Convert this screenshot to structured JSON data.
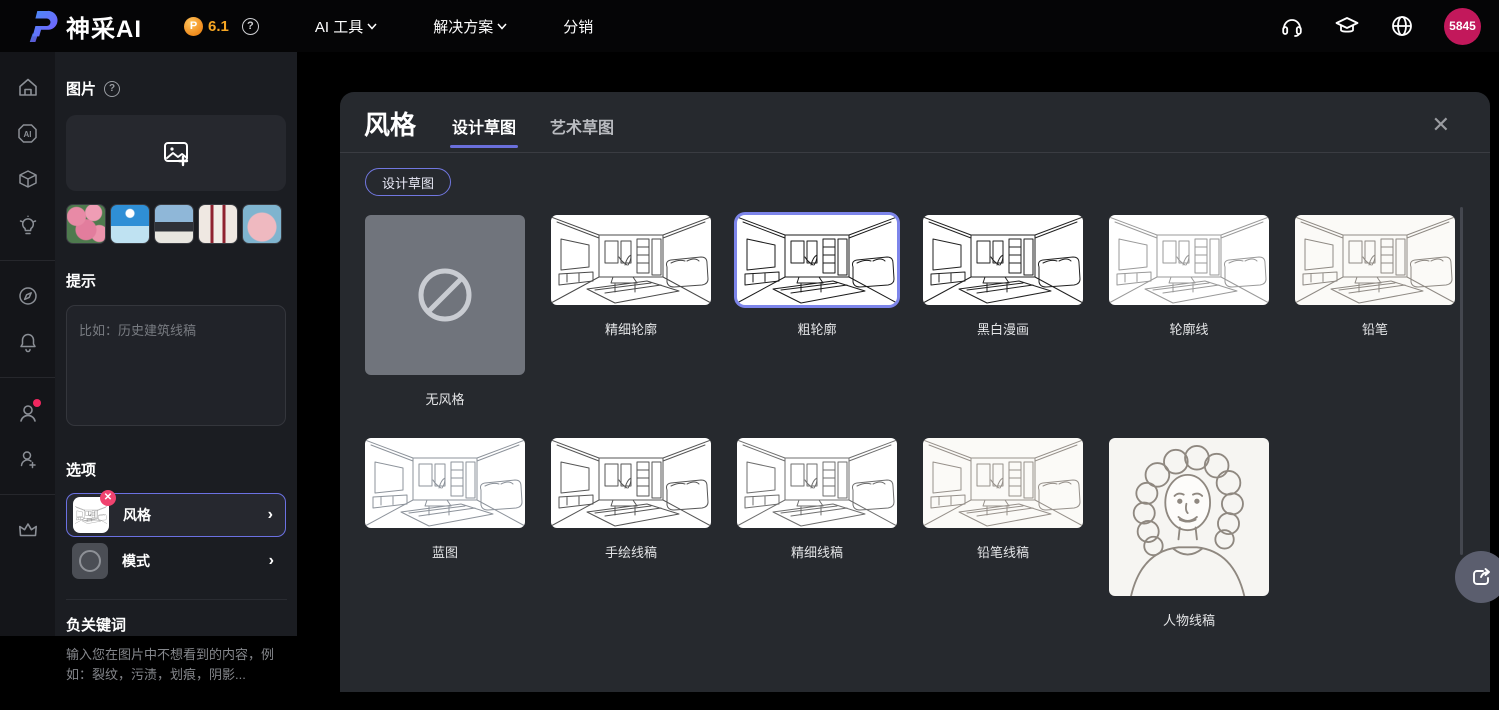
{
  "brand": {
    "name": "神采AI",
    "version": "6.1"
  },
  "navbar": {
    "items": [
      {
        "label": "AI 工具",
        "has_dropdown": true
      },
      {
        "label": "解决方案",
        "has_dropdown": true
      },
      {
        "label": "分销",
        "has_dropdown": false
      }
    ],
    "right_icons": [
      "headphones-icon",
      "graduation-cap-icon",
      "globe-icon"
    ],
    "credits": "5845"
  },
  "sidebar": {
    "icons": [
      "home-icon",
      "ai-hexagon-icon",
      "cube-icon",
      "lightbulb-icon",
      "compass-icon",
      "bell-icon",
      "user-icon",
      "user-add-icon",
      "crown-icon"
    ],
    "user_has_notification_dot": true
  },
  "panel": {
    "image_section": {
      "title": "图片",
      "help_icon": "question-circle-icon",
      "upload_icon": "image-add-icon"
    },
    "samples": [
      "roses-sample",
      "illustration-sample",
      "architecture-sample",
      "fashion-sample",
      "skirt-sample"
    ],
    "prompt": {
      "title": "提示",
      "placeholder": "比如：历史建筑线稿",
      "value": ""
    },
    "options": {
      "title": "选项",
      "rows": [
        {
          "label": "风格",
          "selected": true,
          "removable": true
        },
        {
          "label": "模式",
          "selected": false
        }
      ]
    },
    "negative": {
      "title": "负关键词",
      "placeholder": "输入您在图片中不想看到的内容，例如：裂纹，污渍，划痕，阴影...",
      "value": ""
    }
  },
  "modal": {
    "title": "风格",
    "tabs": [
      {
        "label": "设计草图",
        "active": true
      },
      {
        "label": "艺术草图",
        "active": false
      }
    ],
    "filter_pill": "设计草图",
    "close_icon": "✕",
    "styles": [
      {
        "label": "无风格",
        "type": "none"
      },
      {
        "label": "精细轮廓",
        "type": "sketch"
      },
      {
        "label": "粗轮廓",
        "type": "sketch",
        "selected": true
      },
      {
        "label": "黑白漫画",
        "type": "sketch"
      },
      {
        "label": "轮廓线",
        "type": "sketch"
      },
      {
        "label": "铅笔",
        "type": "sketch"
      },
      {
        "label": "蓝图",
        "type": "sketch"
      },
      {
        "label": "手绘线稿",
        "type": "sketch"
      },
      {
        "label": "精细线稿",
        "type": "sketch"
      },
      {
        "label": "铅笔线稿",
        "type": "sketch"
      },
      {
        "label": "人物线稿",
        "type": "portrait"
      }
    ]
  },
  "colors": {
    "accent": "#6a6fdb",
    "selection_border": "#7d85ea",
    "avatar_bg": "#c2185b",
    "coin_orange": "#f6a623",
    "remove_badge": "#f0436f",
    "modal_bg": "#26292e",
    "panel_bg": "#1b1d22"
  }
}
